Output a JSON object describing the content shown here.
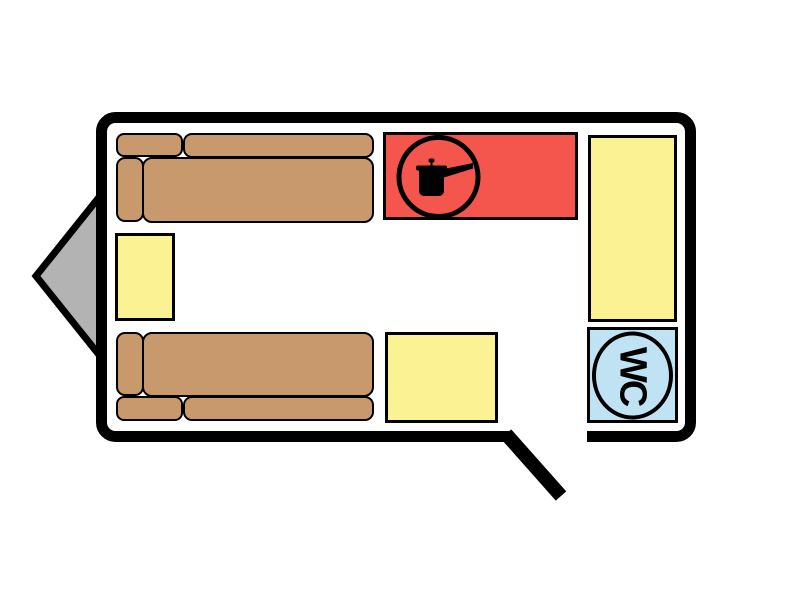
{
  "floorplan": {
    "kind": "caravan-floor-plan",
    "colors": {
      "background": "#ffffff",
      "wall": "#000000",
      "interior": "#ffffff",
      "sofa": "#c8996c",
      "table": "#fbf294",
      "kitchen": "#f4564e",
      "toilet": "#bfe3f2",
      "hitch": "#b3b3b3"
    },
    "toilet": {
      "label": "WC",
      "icon": "wc-circle-badge"
    },
    "kitchen": {
      "icon": "cooking-pot-icon"
    },
    "door": {
      "icon": "open-door-line"
    },
    "hitch": {
      "icon": "tow-hitch-triangle"
    }
  }
}
